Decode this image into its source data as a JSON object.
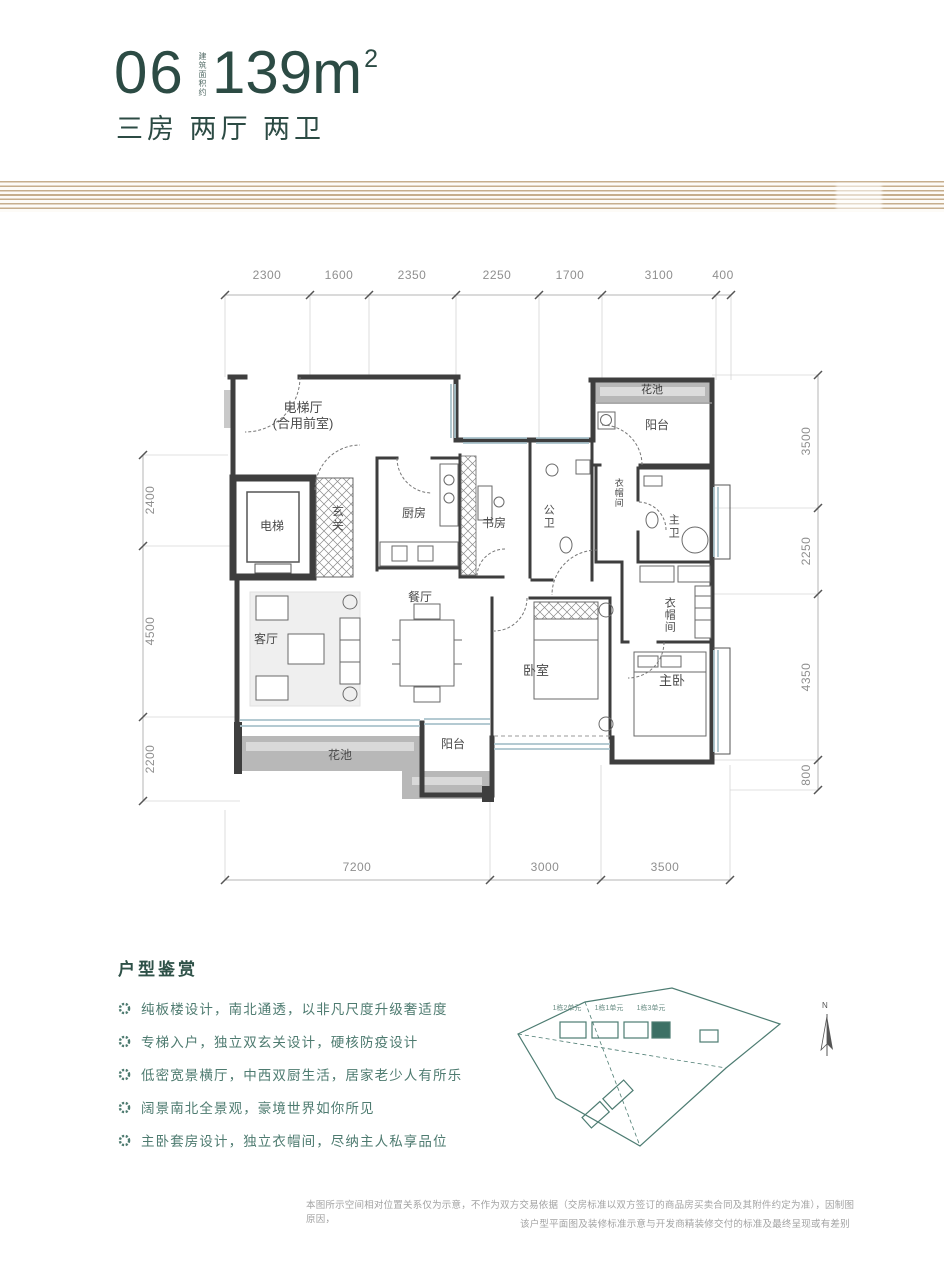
{
  "header": {
    "unit_number": "06",
    "area_note_vertical": "建筑面积约",
    "area_value": "139m",
    "area_sup": "2",
    "subtitle": "三房 两厅 两卫"
  },
  "colors": {
    "accent_dark": "#2c4b44",
    "accent_teal": "#4e7b70",
    "stripe_gold": "#c6ae8d",
    "wall": "#3e3e3e",
    "dim_text": "#8f8f8f",
    "window_glass": "#a9c3cb",
    "flowerbed_gray": "#b8b8b8"
  },
  "dimensions": {
    "top": [
      "2300",
      "1600",
      "2350",
      "2250",
      "1700",
      "3100",
      "400"
    ],
    "left": [
      "2400",
      "4500",
      "2200"
    ],
    "right": [
      "3500",
      "2250",
      "4350",
      "800"
    ],
    "bottom": [
      "7200",
      "3000",
      "3500"
    ]
  },
  "rooms": {
    "elevator_hall_line1": "电梯厅",
    "elevator_hall_line2": "(合用前室)",
    "elevator": "电梯",
    "foyer": "玄关",
    "kitchen": "厨房",
    "study": "书房",
    "public_bath": "公卫",
    "flower_bed_top": "花池",
    "balcony_top": "阳台",
    "closet_small": "衣帽间",
    "master_bath": "主卫",
    "closet": "衣帽间",
    "dining": "餐厅",
    "living": "客厅",
    "bedroom": "卧室",
    "master_bedroom": "主卧",
    "balcony_bottom": "阳台",
    "flower_bed_bottom": "花池"
  },
  "appreciation": {
    "title": "户型鉴赏",
    "bullets": [
      "纯板楼设计，南北通透，以非凡尺度升级奢适度",
      "专梯入户，独立双玄关设计，硬核防疫设计",
      "低密宽景横厅，中西双厨生活，居家老少人有所乐",
      "阔景南北全景观，豪境世界如你所见",
      "主卧套房设计，独立衣帽间，尽纳主人私享品位"
    ]
  },
  "siteplan": {
    "labels": [
      "1栋2单元",
      "1栋1单元",
      "1栋3单元"
    ],
    "compass": "N"
  },
  "disclaimer": {
    "line1": "本图所示空间相对位置关系仅为示意，不作为双方交易依据（交房标准以双方签订的商品房买卖合同及其附件约定为准），因制图原因，",
    "line2": "该户型平面图及装修标准示意与开发商精装修交付的标准及最终呈现或有差别"
  }
}
